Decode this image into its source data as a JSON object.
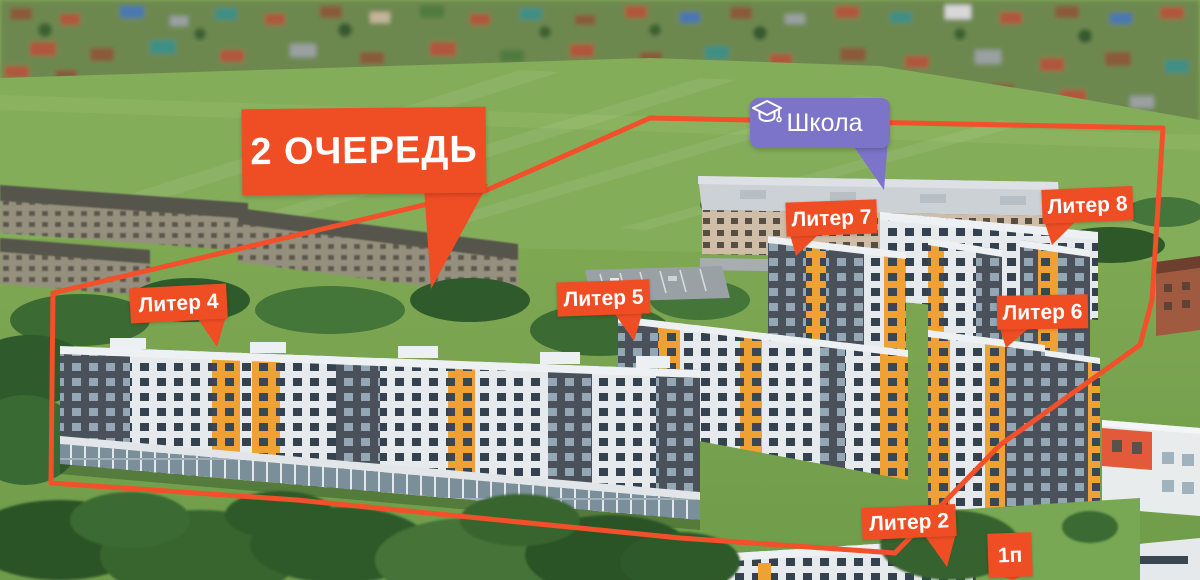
{
  "callout": {
    "text": "2 ОЧЕРЕДЬ"
  },
  "school": {
    "text": "Школа",
    "icon": "graduation-cap-icon"
  },
  "labels": [
    {
      "id": "liter-4",
      "text": "Литер 4"
    },
    {
      "id": "liter-5",
      "text": "Литер 5"
    },
    {
      "id": "liter-7",
      "text": "Литер 7"
    },
    {
      "id": "liter-8",
      "text": "Литер 8"
    },
    {
      "id": "liter-6",
      "text": "Литер 6"
    },
    {
      "id": "liter-2",
      "text": "Литер 2"
    },
    {
      "id": "phase-1",
      "text": "1п"
    }
  ],
  "colors": {
    "accent": "#EF4D24",
    "accent-line": "#F1502B",
    "school-purple": "#7B74C8",
    "label-text": "#FFFFFF"
  }
}
